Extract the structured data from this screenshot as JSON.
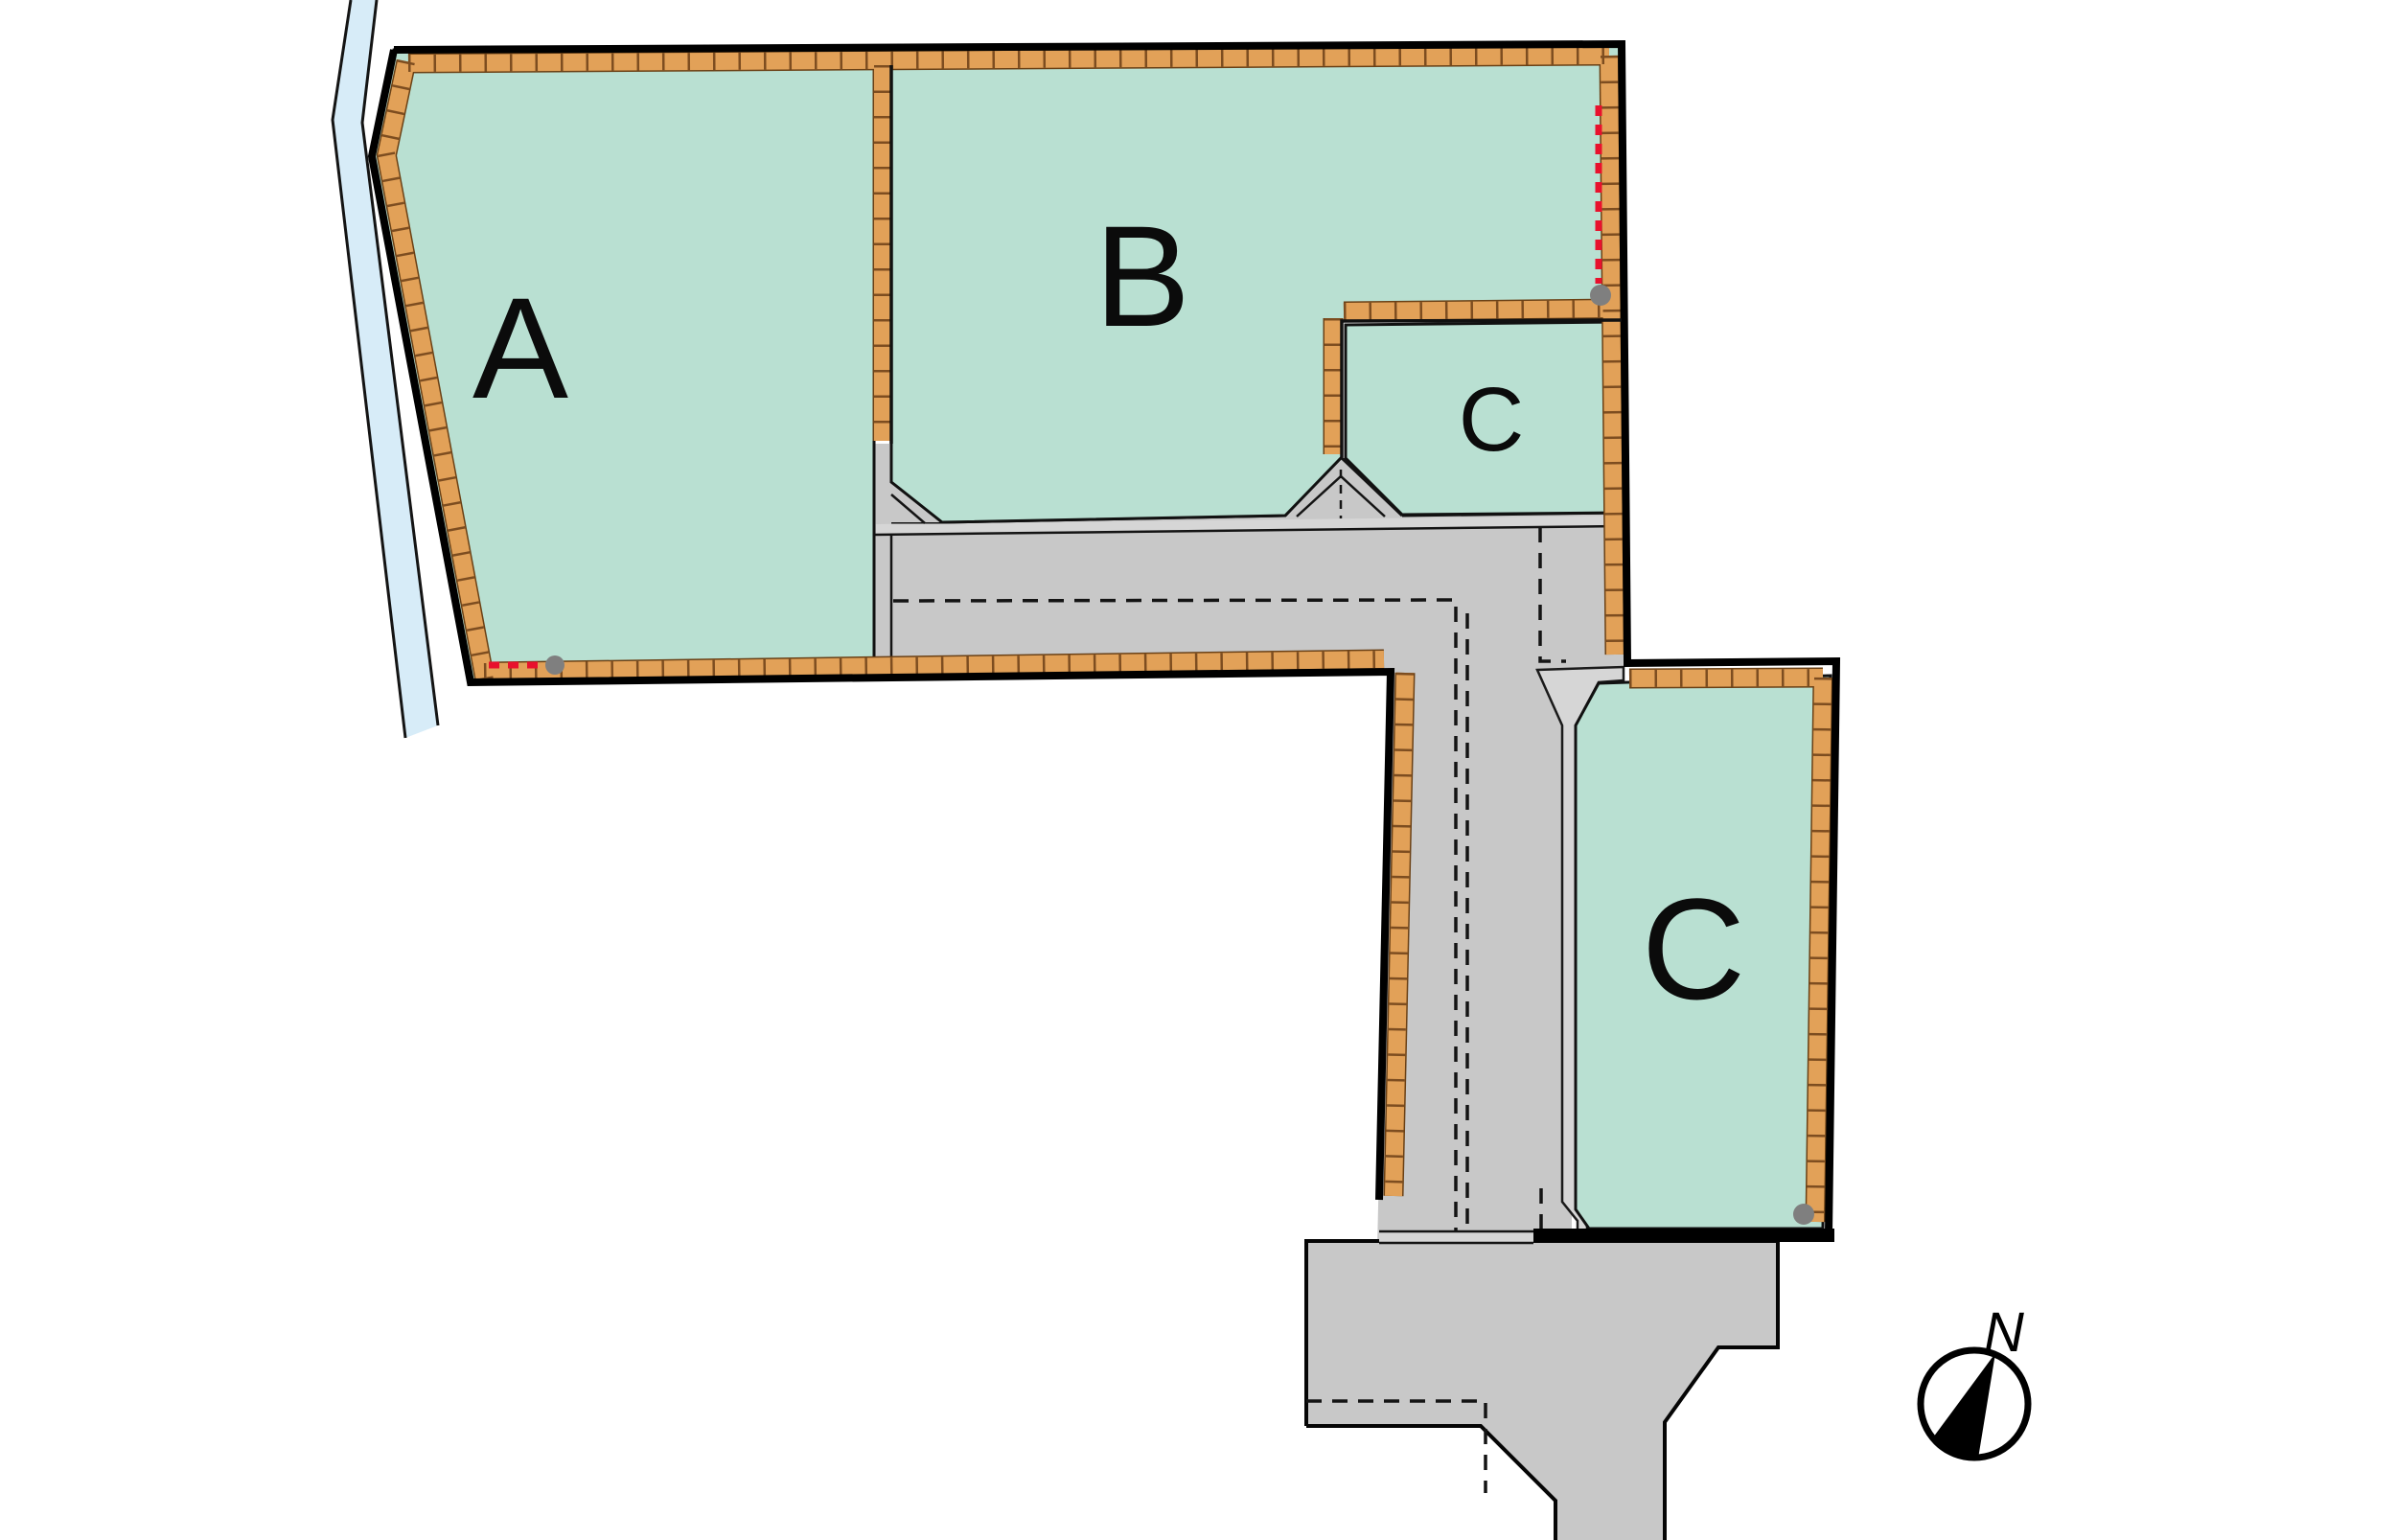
{
  "parcels": [
    {
      "id": "A",
      "label": "A"
    },
    {
      "id": "B",
      "label": "B"
    },
    {
      "id": "C-small",
      "label": "C"
    },
    {
      "id": "C-large",
      "label": "C"
    }
  ],
  "compass": {
    "label": "N"
  },
  "colors": {
    "parcel_green": "#b9e0d2",
    "road_gray": "#c8c8c8",
    "sidewalk_gray": "#d6d6d6",
    "stream_blue": "#d7ecf8",
    "wall_brick": "#e2a158",
    "marker_red": "#e8112d",
    "manhole_gray": "#7f7f7f"
  }
}
